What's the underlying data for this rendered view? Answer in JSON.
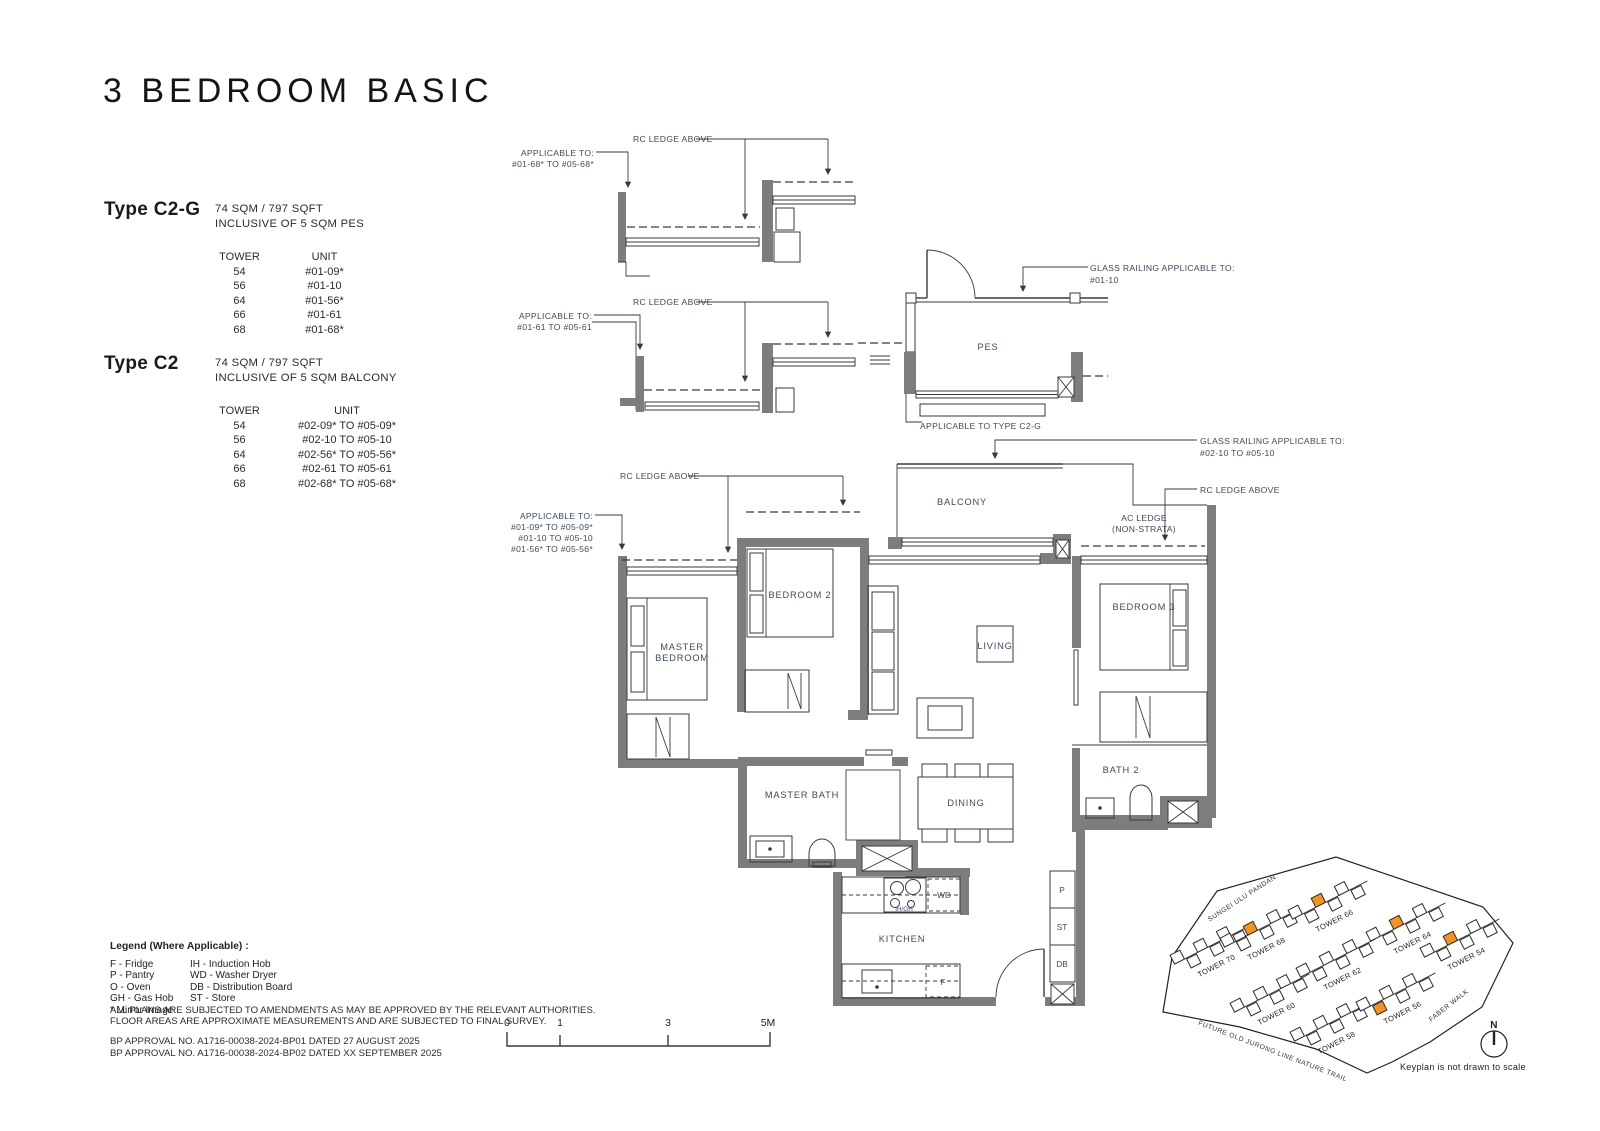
{
  "title": "3 BEDROOM BASIC",
  "types": [
    {
      "name": "Type C2-G",
      "area": "74 SQM / 797 SQFT",
      "inclusive": "INCLUSIVE OF 5 SQM PES",
      "tower_header": "TOWER",
      "unit_header": "UNIT",
      "rows": [
        {
          "tower": "54",
          "unit": "#01-09*"
        },
        {
          "tower": "56",
          "unit": "#01-10"
        },
        {
          "tower": "64",
          "unit": "#01-56*"
        },
        {
          "tower": "66",
          "unit": "#01-61"
        },
        {
          "tower": "68",
          "unit": "#01-68*"
        }
      ]
    },
    {
      "name": "Type C2",
      "area": "74 SQM / 797 SQFT",
      "inclusive": "INCLUSIVE OF 5 SQM BALCONY",
      "tower_header": "TOWER",
      "unit_header": "UNIT",
      "rows": [
        {
          "tower": "54",
          "unit": "#02-09* TO #05-09*"
        },
        {
          "tower": "56",
          "unit": "#02-10 TO #05-10"
        },
        {
          "tower": "64",
          "unit": "#02-56* TO #05-56*"
        },
        {
          "tower": "66",
          "unit": "#02-61 TO #05-61"
        },
        {
          "tower": "68",
          "unit": "#02-68* TO #05-68*"
        }
      ]
    }
  ],
  "legend": {
    "title": "Legend (Where Applicable) :",
    "col1": [
      "F - Fridge",
      "P - Pantry",
      "O - Oven",
      "GH - Gas Hob",
      "* Mirror Image"
    ],
    "col2": [
      "IH - Induction Hob",
      "WD - Washer Dryer",
      "DB - Distribution Board",
      "ST - Store"
    ]
  },
  "disclaimers": [
    "ALL PLANS ARE SUBJECTED TO AMENDMENTS AS MAY BE APPROVED BY THE RELEVANT AUTHORITIES.",
    "FLOOR AREAS ARE APPROXIMATE MEASUREMENTS AND ARE SUBJECTED TO FINAL SURVEY."
  ],
  "approvals": [
    "BP APPROVAL NO. A1716-00038-2024-BP01  DATED 27 AUGUST 2025",
    "BP APPROVAL NO. A1716-00038-2024-BP02  DATED XX SEPTEMBER 2025"
  ],
  "scale": {
    "t0": "0",
    "t1": "1",
    "t3": "3",
    "t5": "5M"
  },
  "plan": {
    "ann": {
      "rc_ledge_1": "RC LEDGE ABOVE",
      "app1_l1": "APPLICABLE TO:",
      "app1_l2": "#01-68* TO #05-68*",
      "rc_ledge_2": "RC LEDGE ABOVE",
      "app2_l1": "APPLICABLE TO:",
      "app2_l2": "#01-61 TO #05-61",
      "glass1_l1": "GLASS RAILING APPLICABLE TO:",
      "glass1_l2": "#01-10",
      "app_c2g": "APPLICABLE TO TYPE C2-G",
      "rc_ledge_3": "RC LEDGE ABOVE",
      "app3_l1": "APPLICABLE TO:",
      "app3_l2": "#01-09* TO #05-09*",
      "app3_l3": "#01-10 TO #05-10",
      "app3_l4": "#01-56* TO #05-56*",
      "glass2_l1": "GLASS RAILING APPLICABLE TO:",
      "glass2_l2": "#02-10 TO #05-10",
      "rc_ledge_4": "RC LEDGE ABOVE",
      "ac_ledge_l1": "AC LEDGE",
      "ac_ledge_l2": "(NON-STRATA)"
    },
    "rooms": {
      "pes": "PES",
      "balcony": "BALCONY",
      "master_l1": "MASTER",
      "master_l2": "BEDROOM",
      "bedroom2": "BEDROOM 2",
      "living": "LIVING",
      "bedroom3": "BEDROOM 3",
      "master_bath": "MASTER BATH",
      "dining": "DINING",
      "bath2": "BATH 2",
      "kitchen": "KITCHEN"
    },
    "tags": {
      "wd": "WD",
      "ih_gh": "IH/GH",
      "f": "F",
      "p": "P",
      "st": "ST",
      "db": "DB"
    }
  },
  "keyplan": {
    "towers": [
      "TOWER 70",
      "TOWER 68",
      "TOWER 66",
      "TOWER 60",
      "TOWER 62",
      "TOWER 64",
      "TOWER 58",
      "TOWER 56",
      "TOWER 54"
    ],
    "streets": [
      "SUNGEI ULU PANDAN",
      "FABER WALK",
      "FUTURE OLD JURONG LINE NATURE TRAIL"
    ],
    "north": "N",
    "note": "Keyplan is not drawn to scale"
  },
  "colors": {
    "wall": "#7d7d7d",
    "label": "#3c4b60",
    "orange": "#f6921e"
  }
}
